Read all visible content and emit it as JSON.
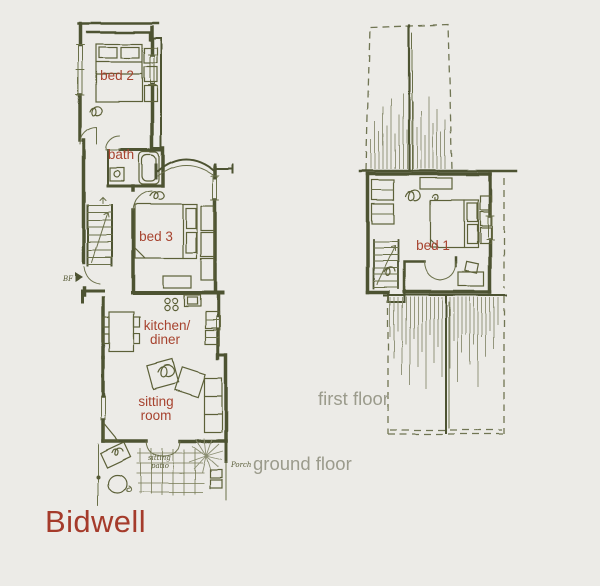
{
  "page": {
    "background": "#ecebe7"
  },
  "palette": {
    "ink": "#4e5230",
    "furniture_line": "#5c6038",
    "roof_hatch": "#8b8e72",
    "label_red": "#a7432f",
    "caption_gray": "#9b9b8c",
    "title_red": "#a53b2b",
    "handwriting": "#565a35"
  },
  "title": {
    "text": "Bidwell"
  },
  "ground_floor": {
    "caption": "ground floor",
    "rooms": {
      "bed2": "bed 2",
      "bath": "bath",
      "bed3": "bed 3",
      "kitchen_line1": "kitchen/",
      "kitchen_line2": "diner",
      "sitting_line1": "sitting",
      "sitting_line2": "room"
    },
    "annotations": {
      "boiler": "BF",
      "patio_line1": "sitting",
      "patio_line2": "patio",
      "porch": "Porch"
    }
  },
  "first_floor": {
    "caption": "first floor",
    "rooms": {
      "bed1": "bed 1"
    }
  }
}
